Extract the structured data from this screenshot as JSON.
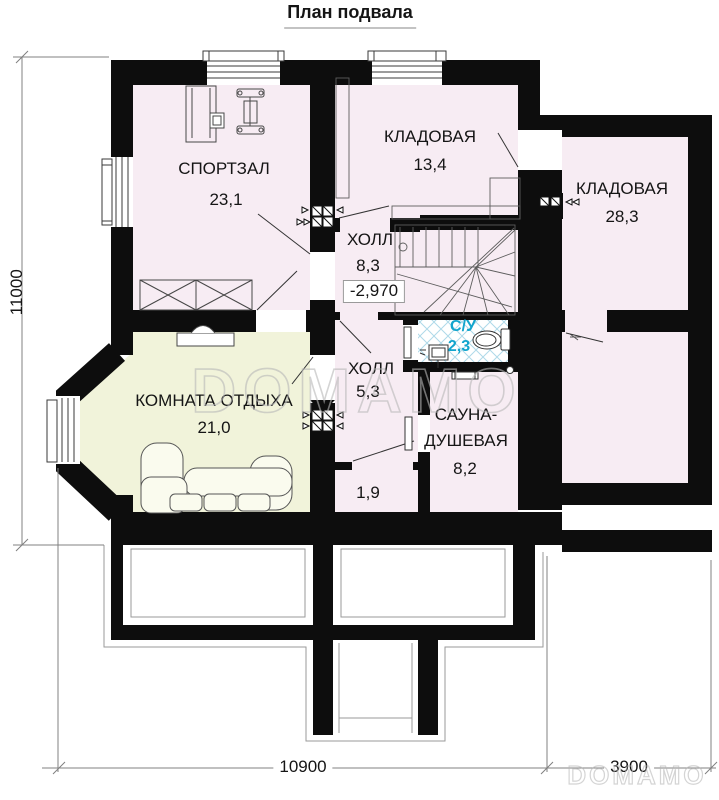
{
  "title": "План подвала",
  "watermark": "DOMAMO",
  "rooms": {
    "gym": {
      "name": "СПОРТЗАЛ",
      "area": "23,1"
    },
    "storage_top": {
      "name": "КЛАДОВАЯ",
      "area": "13,4"
    },
    "storage_right": {
      "name": "КЛАДОВАЯ",
      "area": "28,3"
    },
    "hall_upper": {
      "name": "ХОЛЛ",
      "area": "8,3",
      "elevation": "-2,970"
    },
    "wc": {
      "name": "С/У",
      "area": "2,3"
    },
    "hall_lower": {
      "name": "ХОЛЛ",
      "area": "5,3"
    },
    "lounge": {
      "name": "КОМНАТА ОТДЫХА",
      "area": "21,0"
    },
    "sauna": {
      "name_line1": "САУНА-",
      "name_line2": "ДУШЕВАЯ",
      "area": "8,2"
    },
    "closet": {
      "area": "1,9"
    }
  },
  "dimensions": {
    "height": "11000",
    "width_main": "10900",
    "width_wing": "3900"
  },
  "colors": {
    "room_pink": "#f7ecf3",
    "room_yellow": "#f1f3da",
    "wall": "#0d0d0d",
    "wc_text": "#12a5cd",
    "tile_line": "#aed9e9",
    "watermark": "#b8b8b8"
  }
}
